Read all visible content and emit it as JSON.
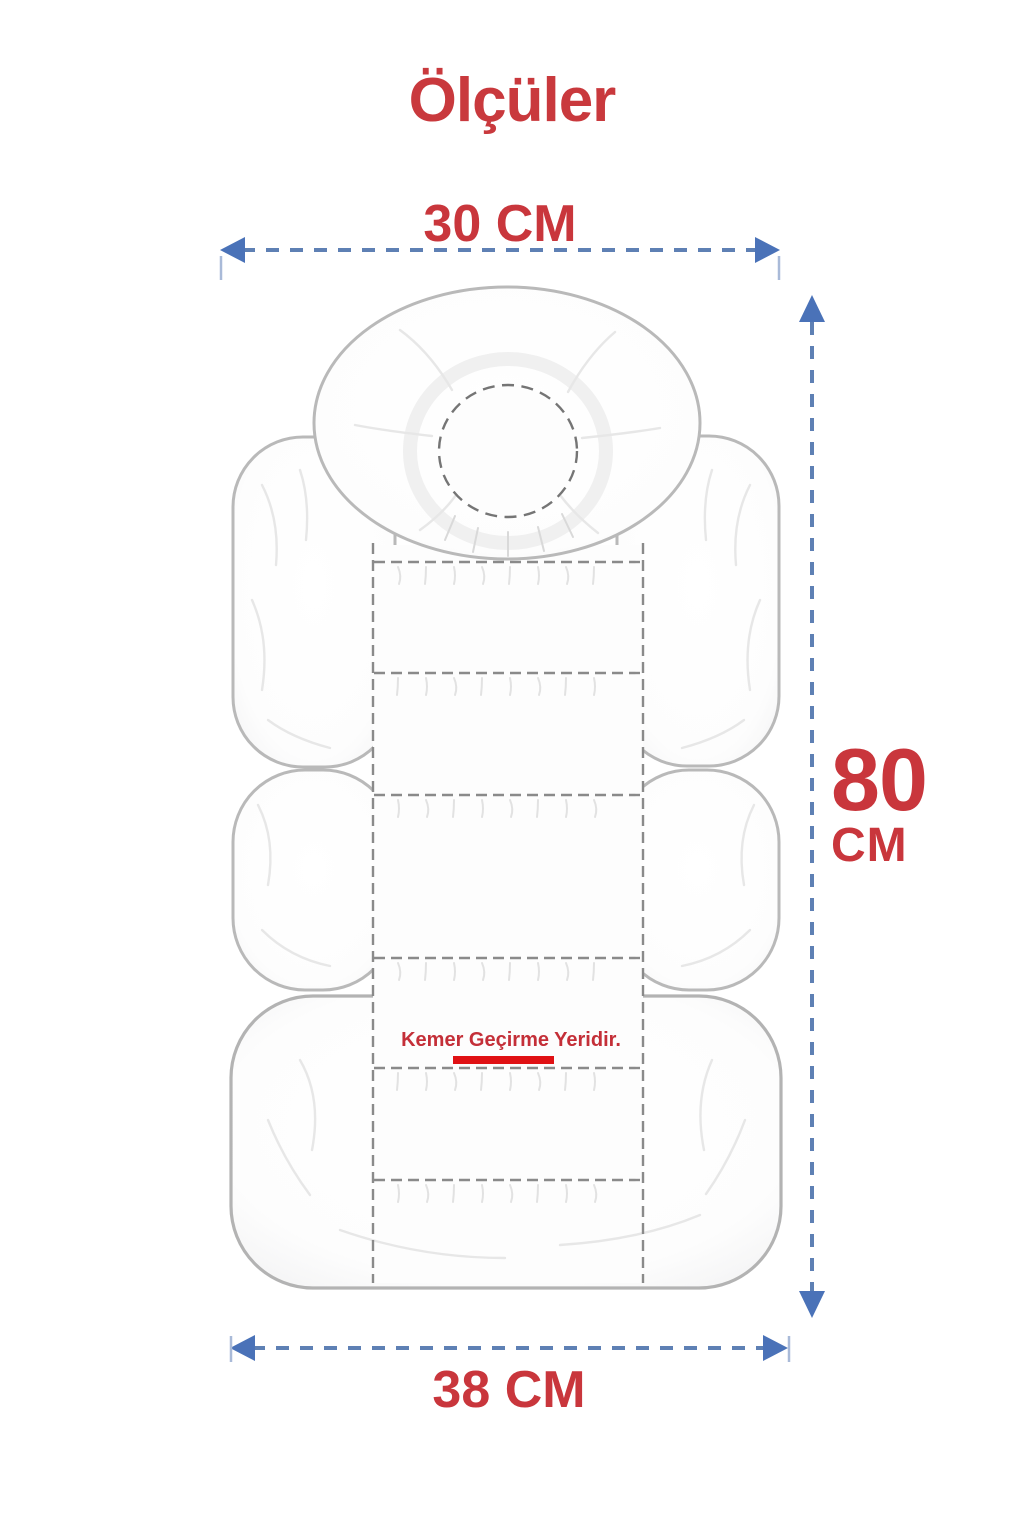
{
  "title": {
    "text": "Ölçüler"
  },
  "measurements": {
    "top_width": {
      "label": "30 CM"
    },
    "height": {
      "value": "80",
      "unit": "CM"
    },
    "bottom_width": {
      "label": "38 CM"
    }
  },
  "belt_note": {
    "text": "Kemer Geçirme Yeridir."
  },
  "colors": {
    "heading_red": "#c9393d",
    "measure_red": "#c9363c",
    "belt_text_red": "#c42f38",
    "belt_underline_red": "#e01114",
    "arrow_dash_blue": "#5e80b4",
    "arrow_head_blue": "#4a72b8",
    "arrow_tick_blue": "#a9bad8",
    "cushion_outline_gray": "#b9b9b9",
    "seam_dash_gray": "#8a8a8a",
    "headrest_circle_gray": "#757575"
  }
}
